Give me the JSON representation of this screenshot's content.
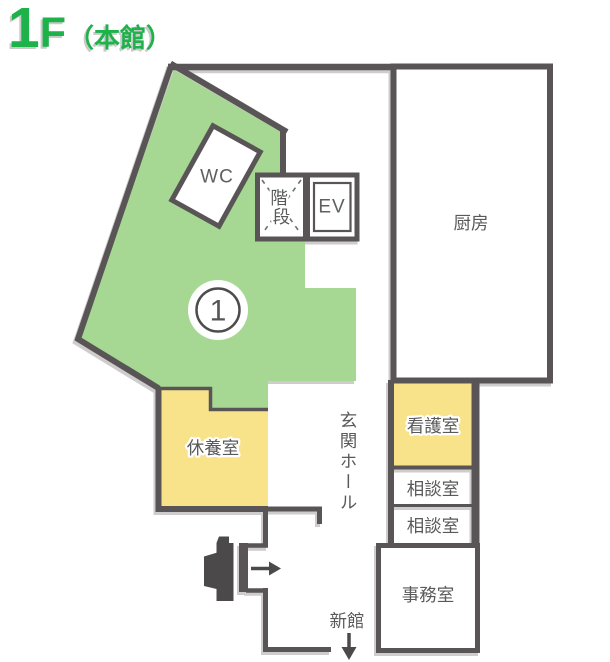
{
  "title": {
    "floor_digit": "1",
    "floor_letter": "F",
    "building": "（本館）",
    "color": "#1eb24b"
  },
  "colors": {
    "wall": "#595557",
    "area_green": "#a6d893",
    "room_yellow": "#f8e38a",
    "label_text": "#595959",
    "arrow": "#4c494b"
  },
  "rooms": {
    "wc": "WC",
    "stairs": "階段",
    "stairs_chars": [
      "階",
      "段"
    ],
    "elevator": "EV",
    "kitchen": "厨房",
    "rest_room": "休養室",
    "nurse_office": "看護室",
    "entrance_hall": "玄関ホール",
    "consult_room_1": "相談室",
    "consult_room_2": "相談室",
    "office": "事務室"
  },
  "markers": {
    "area_badge_number": "1",
    "new_wing_label": "新館"
  }
}
